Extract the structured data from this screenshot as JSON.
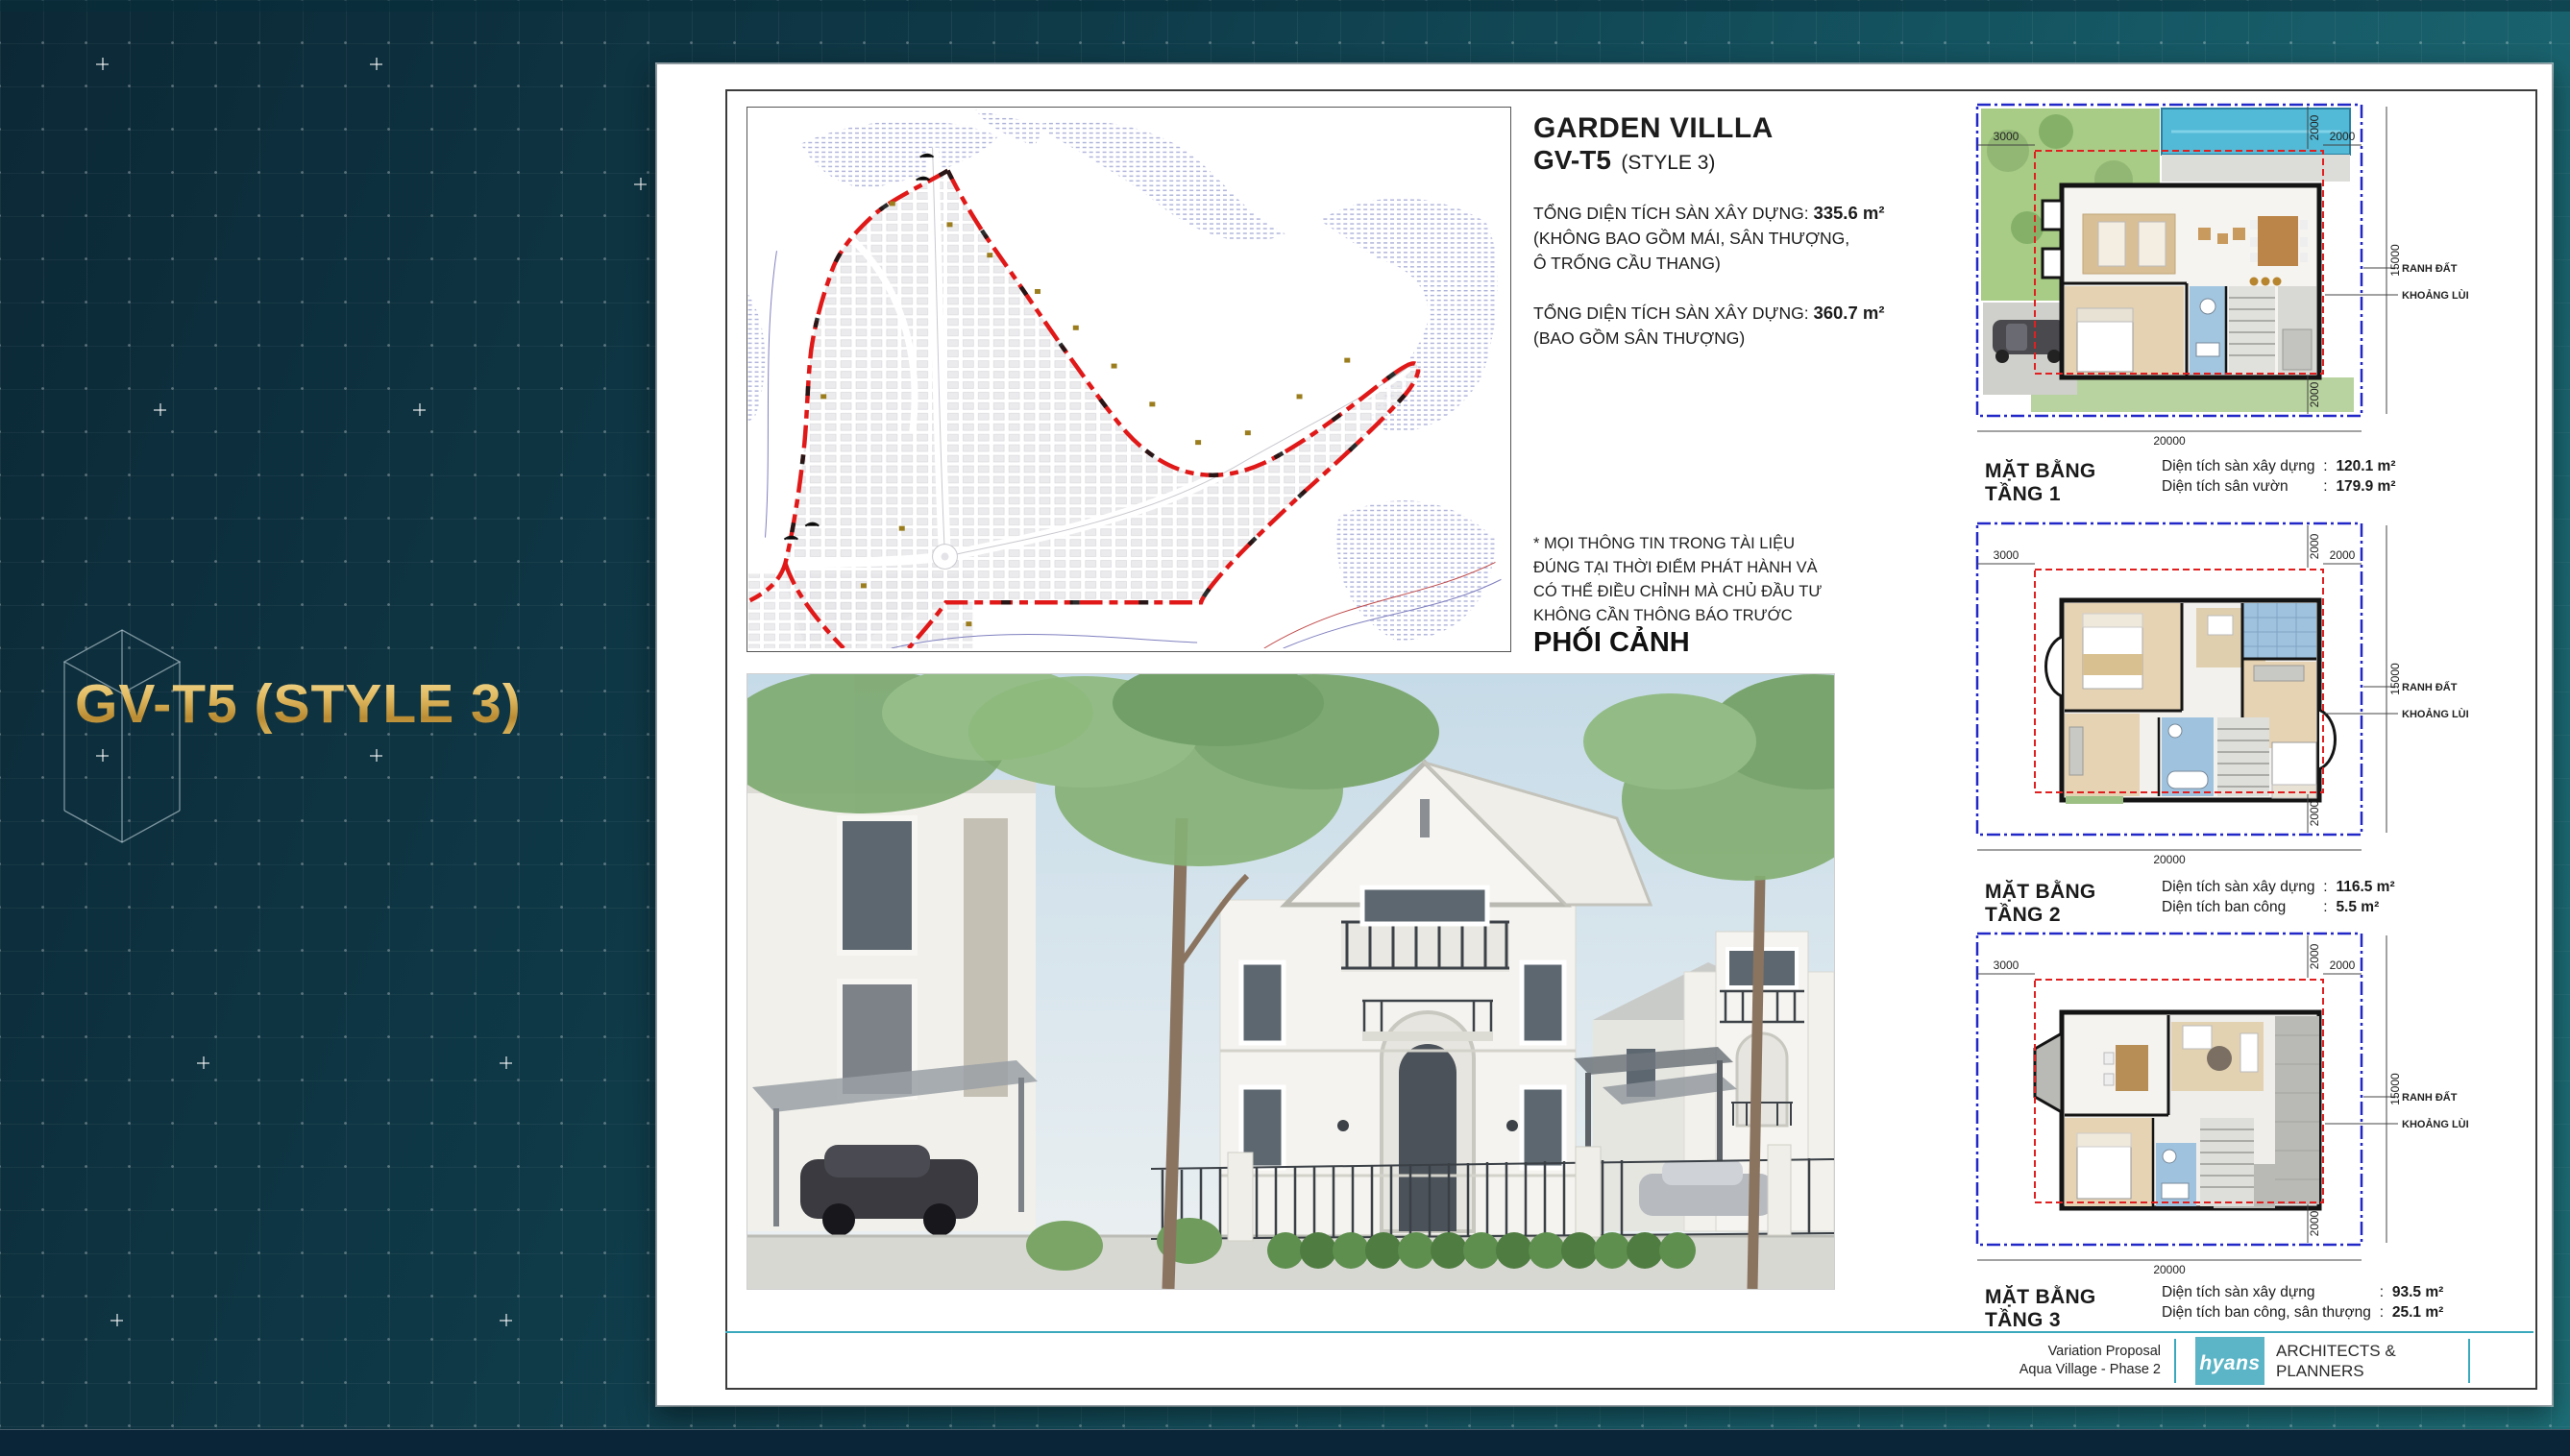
{
  "slide": {
    "title": "GV-T5 (STYLE 3)"
  },
  "document": {
    "header": {
      "title": "GARDEN VILLLA",
      "code": "GV-T5",
      "style_note": "(STYLE 3)",
      "area_blocks": [
        {
          "label": "TỔNG DIỆN TÍCH SÀN XÂY DỰNG:",
          "value": "335.6 m²",
          "note1": "(KHÔNG BAO GỒM MÁI, SÂN THƯỢNG,",
          "note2": "Ô TRỐNG CẦU THANG)"
        },
        {
          "label": "TỔNG DIỆN TÍCH SÀN XÂY DỰNG:",
          "value": "360.7 m²",
          "note1": "(BAO GỒM SÂN THƯỢNG)",
          "note2": ""
        }
      ],
      "disclaimer_line1": "* MỌI THÔNG TIN TRONG TÀI LIỆU",
      "disclaimer_line2": "ĐÚNG TẠI THỜI ĐIỂM PHÁT HÀNH VÀ",
      "disclaimer_line3": "CÓ THỂ ĐIỀU CHỈNH MÀ CHỦ ĐẦU TƯ",
      "disclaimer_line4": "KHÔNG CẦN THÔNG BÁO TRƯỚC",
      "perspective_heading": "PHỐI CẢNH"
    },
    "stat_separator": ":",
    "plan_dims": {
      "left_setback": "3000",
      "right_setback": "2000",
      "top_setback": "2000",
      "bottom_setback": "2000",
      "lot_depth": "15000",
      "lot_width": "20000",
      "boundary_label": "RANH ĐẤT",
      "setback_label": "KHOẢNG LÙI"
    },
    "plans": [
      {
        "caption": "MẶT BẰNG TẦNG 1",
        "stats": [
          {
            "label": "Diện tích sàn xây dựng",
            "value": "120.1 m²"
          },
          {
            "label": "Diện tích sân vườn",
            "value": "179.9 m²"
          }
        ]
      },
      {
        "caption": "MẶT BẰNG TẦNG 2",
        "stats": [
          {
            "label": "Diện tích sàn xây dựng",
            "value": "116.5 m²"
          },
          {
            "label": "Diện tích ban công",
            "value": "5.5 m²"
          }
        ]
      },
      {
        "caption": "MẶT BẰNG TẦNG 3",
        "stats": [
          {
            "label": "Diện tích sàn xây dựng",
            "value": "93.5 m²"
          },
          {
            "label": "Diện tích ban công, sân thượng",
            "value": "25.1 m²"
          }
        ]
      }
    ],
    "footer": {
      "project_line1": "Variation Proposal",
      "project_line2": "Aqua Village - Phase 2",
      "logo_text": "hyans",
      "firm_line1": "ARCHITECTS &",
      "firm_line2": "PLANNERS"
    }
  }
}
